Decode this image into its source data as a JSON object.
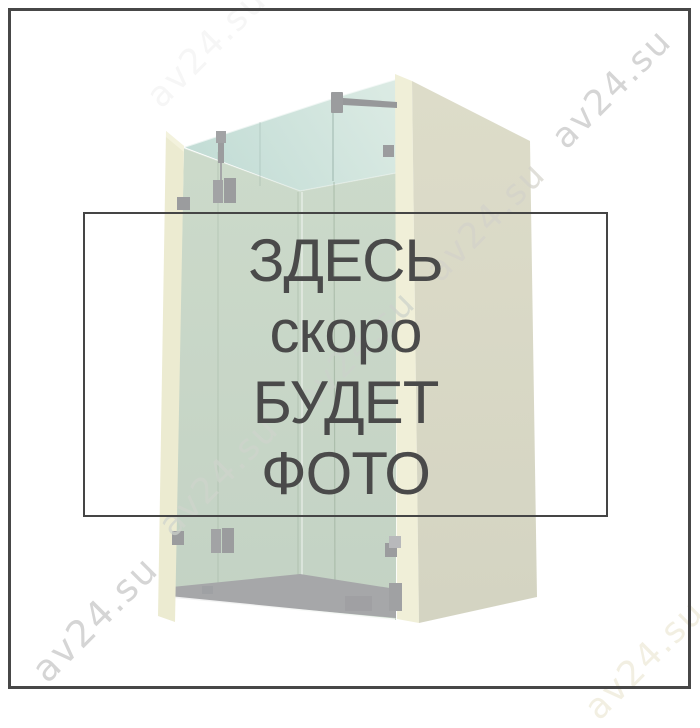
{
  "placeholder_panel": {
    "lines": [
      "ЗДЕСЬ",
      "скоро",
      "БУДЕТ",
      "ФОТО"
    ],
    "full_text": "ЗДЕСЬ скоро БУДЕТ ФОТО"
  },
  "watermark": {
    "text": "av24.su",
    "count": 7
  },
  "illustration": {
    "subject": "glass walk-in shower enclosure 3d render"
  },
  "colors": {
    "frame_border": "#474747",
    "panel_border": "#454545",
    "text": "#4a4a4a",
    "watermark_gray": "#c4c4c4",
    "glass_teal": "#c8e0d9",
    "glass_sage": "#c8d6c8",
    "wall_cream": "#ecebd1",
    "wall_face": "#d8d8c6",
    "floor_gray": "#a6a7a9",
    "hardware_gray": "#9b9c9e"
  }
}
